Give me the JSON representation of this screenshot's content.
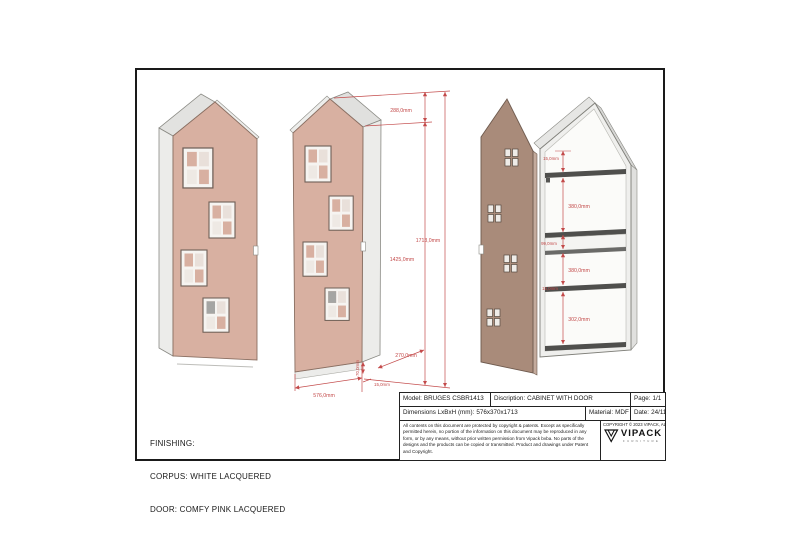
{
  "colors": {
    "dimension_red": "#c34a4a",
    "door_pink": "#d8b0a1",
    "open_door_taupe": "#a98b7a",
    "corpus_white": "#efefed",
    "shelf_dark": "#4f4f4d",
    "frame_black": "#1a1a1a"
  },
  "finishing": {
    "lines": [
      "FINISHING:",
      "CORPUS: WHITE LACQUERED",
      "DOOR: COMFY PINK LACQUERED"
    ]
  },
  "title_block": {
    "model_label": "Model:",
    "model_value": "BRUGES CSBR1413",
    "description_label": "Discription:",
    "description_value": "CABINET WITH DOOR",
    "page_label": "Page:",
    "page_value": "1/1",
    "dimensions_label": "Dimensions LxBxH (mm):",
    "dimensions_value": "576x370x1713",
    "material_label": "Material:",
    "material_value": "MDF",
    "date_label": "Date:",
    "date_value": "24/11/2023",
    "disclaimer": "All contents on this document are protected by copyright & patents. Except as specifically permitted herein, no portion of the information on this document may be reproduced in any form, or by any means, without prior written permission from Vipack bvba. No parts of the designs and the products can be copied or transmitted. Product and drawings under Patent and Copyright.",
    "copyright": "COPYRIGHT © 2023 VIPACK, ALL RIGHTS RESERVED",
    "brand": "VIPACK",
    "brand_sub": "FURNITURE"
  },
  "front_view_dimensions": {
    "gable_height": "288,0mm",
    "total_height": "1713,0mm",
    "body_height": "1425,0mm",
    "width": "576,0mm",
    "door_thickness": "15,0mm",
    "depth": "270,0mm",
    "plinth_height": "70,0mm"
  },
  "open_view_dimensions": {
    "top_gap": "15,0mm",
    "upper_section": "380,0mm",
    "niche_height": "99,0mm",
    "middle_section": "380,0mm",
    "shelf_thickness": "15,0mm",
    "bottom_section": "302,0mm"
  }
}
